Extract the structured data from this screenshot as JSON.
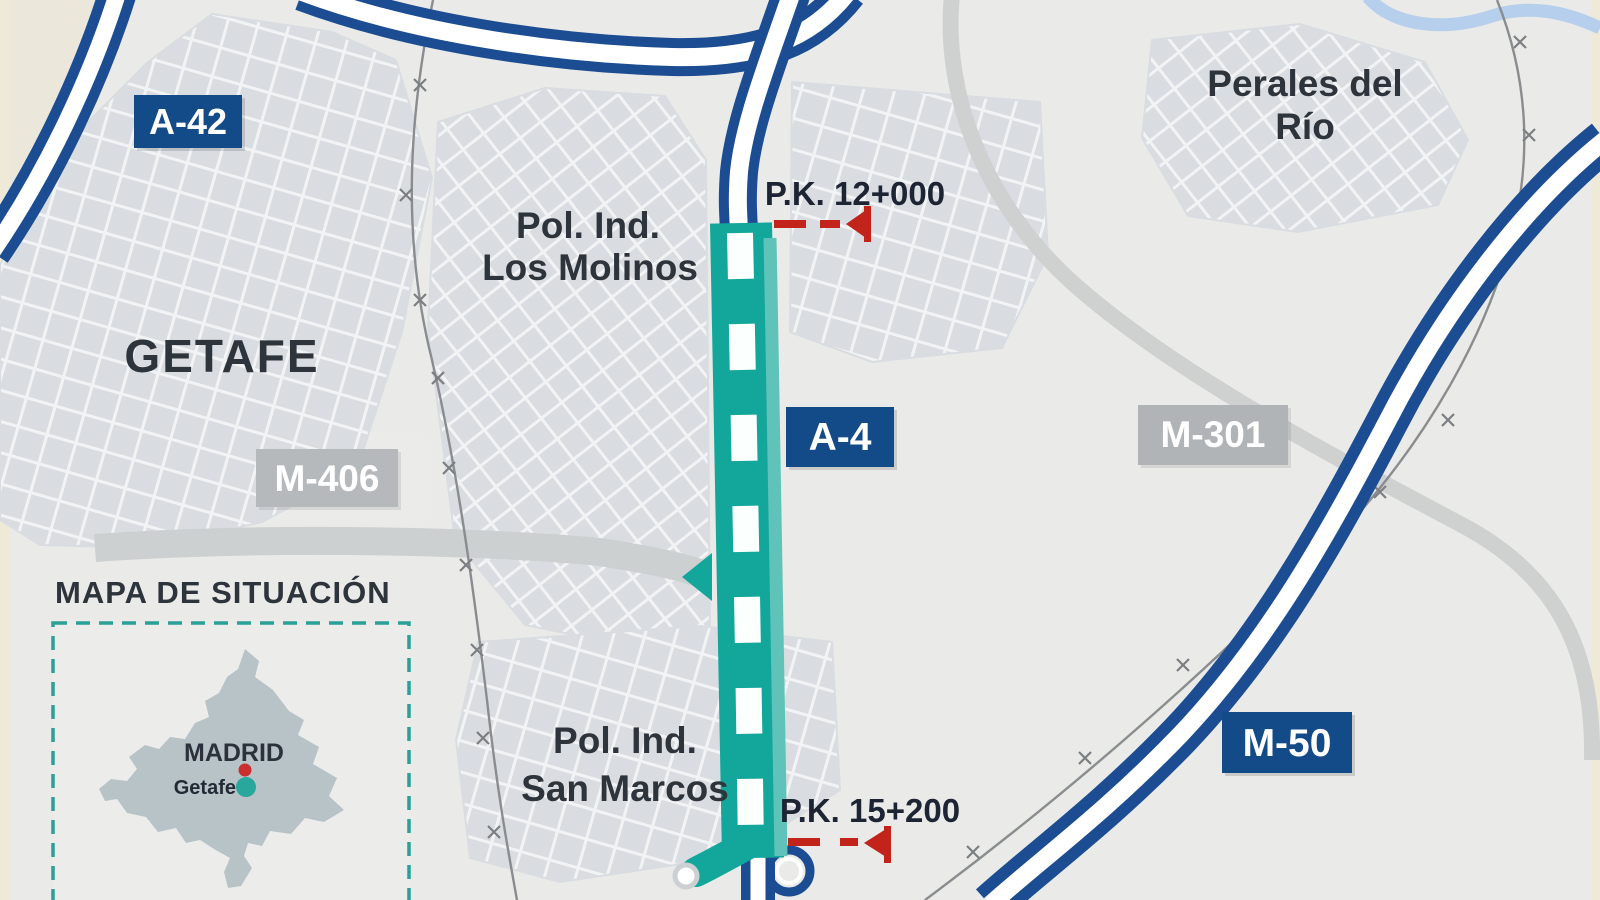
{
  "labels": {
    "getafe": "GETAFE",
    "perales_line1": "Perales del",
    "perales_line2": "Río",
    "los_molinos_line1": "Pol. Ind.",
    "los_molinos_line2": "Los Molinos",
    "san_marcos_line1": "Pol. Ind.",
    "san_marcos_line2": "San Marcos"
  },
  "badges": {
    "a42": "A-42",
    "a4": "A-4",
    "m406": "M-406",
    "m301": "M-301",
    "m50": "M-50"
  },
  "km_markers": {
    "start": "P.K. 12+000",
    "end": "P.K. 15+200"
  },
  "inset": {
    "title": "MAPA DE SITUACIÓN",
    "region": "MADRID",
    "city": "Getafe"
  },
  "colors": {
    "background": "#eaeae8",
    "urban": "#d9dde1",
    "highway_blue": "#1c4d92",
    "badge_blue": "#134a88",
    "badge_gray": "#b4b7b9",
    "project_teal": "#13a79b",
    "project_teal_light": "#5fc3ba",
    "marker_red": "#c2241c",
    "gray_road": "#cfd1d1",
    "railway": "#8a8d8f",
    "river_blue": "#b5cfec",
    "inset_border": "#2aa096",
    "region_fill": "#b8c3c8",
    "madrid_dot": "#c92f2f",
    "getafe_dot": "#29a79d"
  }
}
